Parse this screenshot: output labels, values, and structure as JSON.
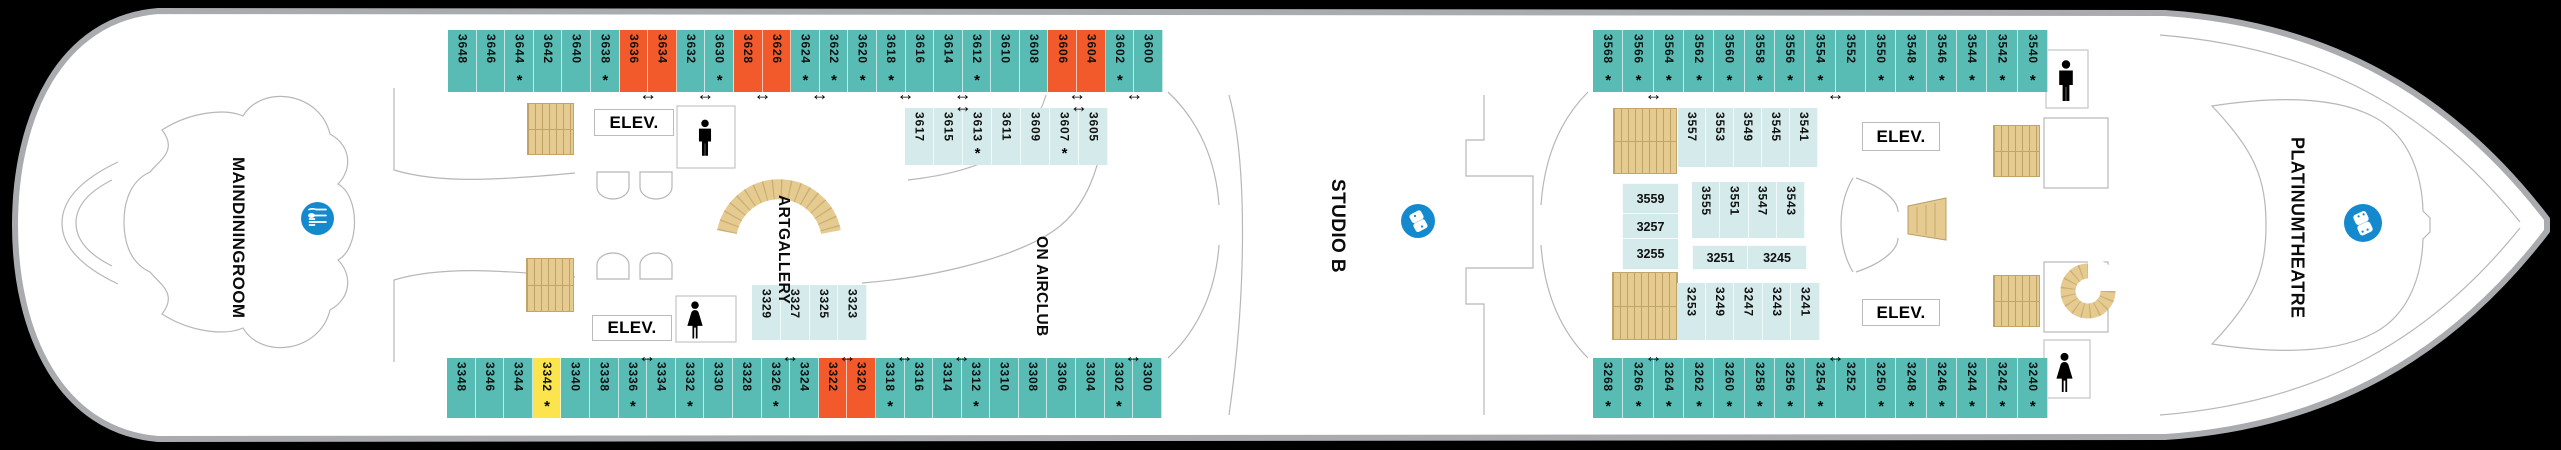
{
  "colors": {
    "teal": "#59BCB4",
    "orange": "#F2592B",
    "yellow": "#FBE44D",
    "inner": "#D4EAEB",
    "stairs": "#E6CB90",
    "blue": "#1489CE"
  },
  "glyphs": {
    "asterisk": "*",
    "door_arrow": "↔"
  },
  "labels": {
    "elevator": "ELEV."
  },
  "venues": {
    "main_dining_room": {
      "lines": [
        "MAIN",
        "DINING",
        "ROOM"
      ]
    },
    "art_gallery": {
      "lines": [
        "ART",
        "GALLERY"
      ]
    },
    "on_air_club": {
      "lines": [
        "ON AIR",
        "CLUB"
      ]
    },
    "studio_b": {
      "lines": [
        "STUDIO B"
      ]
    },
    "platinum_theatre": {
      "lines": [
        "PLATINUM",
        "THEATRE"
      ]
    }
  },
  "units": {
    "u3559": "3559",
    "u3257": "3257",
    "u3255": "3255",
    "u3251": "3251",
    "u3245": "3245"
  },
  "rows": {
    "tl_outer": {
      "edge": "bottom",
      "arrows": [
        6,
        8,
        10,
        12,
        15,
        17,
        21,
        23
      ],
      "cells": [
        [
          "3648",
          "s",
          0
        ],
        [
          "3646",
          "s",
          0
        ],
        [
          "3644",
          "s",
          1
        ],
        [
          "3642",
          "s",
          0
        ],
        [
          "3640",
          "s",
          0
        ],
        [
          "3638",
          "s",
          1
        ],
        [
          "3636",
          "o",
          0
        ],
        [
          "3634",
          "o",
          0
        ],
        [
          "3632",
          "s",
          0
        ],
        [
          "3630",
          "s",
          1
        ],
        [
          "3628",
          "o",
          0
        ],
        [
          "3626",
          "o",
          0
        ],
        [
          "3624",
          "s",
          1
        ],
        [
          "3622",
          "s",
          1
        ],
        [
          "3620",
          "s",
          1
        ],
        [
          "3618",
          "s",
          1
        ],
        [
          "3616",
          "s",
          0
        ],
        [
          "3614",
          "s",
          0
        ],
        [
          "3612",
          "s",
          1
        ],
        [
          "3610",
          "s",
          0
        ],
        [
          "3608",
          "s",
          0
        ],
        [
          "3606",
          "o",
          0
        ],
        [
          "3604",
          "o",
          0
        ],
        [
          "3602",
          "s",
          1
        ],
        [
          "3600",
          "s",
          0
        ]
      ]
    },
    "tl_inner": {
      "edge": "top",
      "arrows": [
        1,
        5
      ],
      "cells": [
        [
          "3617",
          "i",
          0
        ],
        [
          "3615",
          "i",
          0
        ],
        [
          "3613",
          "i",
          1
        ],
        [
          "3611",
          "i",
          0
        ],
        [
          "3609",
          "i",
          0
        ],
        [
          "3607",
          "i",
          1
        ],
        [
          "3605",
          "i",
          0
        ]
      ]
    },
    "bl_outer": {
      "edge": "top",
      "arrows": [
        6,
        11,
        13,
        15,
        17,
        23
      ],
      "cells": [
        [
          "3348",
          "s",
          0
        ],
        [
          "3346",
          "s",
          0
        ],
        [
          "3344",
          "s",
          0
        ],
        [
          "3342",
          "y",
          1
        ],
        [
          "3340",
          "s",
          0
        ],
        [
          "3338",
          "s",
          0
        ],
        [
          "3336",
          "s",
          1
        ],
        [
          "3334",
          "s",
          0
        ],
        [
          "3332",
          "s",
          1
        ],
        [
          "3330",
          "s",
          0
        ],
        [
          "3328",
          "s",
          0
        ],
        [
          "3326",
          "s",
          1
        ],
        [
          "3324",
          "s",
          0
        ],
        [
          "3322",
          "o",
          0
        ],
        [
          "3320",
          "o",
          0
        ],
        [
          "3318",
          "s",
          1
        ],
        [
          "3316",
          "s",
          0
        ],
        [
          "3314",
          "s",
          0
        ],
        [
          "3312",
          "s",
          1
        ],
        [
          "3310",
          "s",
          0
        ],
        [
          "3308",
          "s",
          0
        ],
        [
          "3306",
          "s",
          0
        ],
        [
          "3304",
          "s",
          0
        ],
        [
          "3302",
          "s",
          1
        ],
        [
          "3300",
          "s",
          0
        ]
      ]
    },
    "bl_inner": {
      "edge": "top",
      "arrows": [],
      "cells": [
        [
          "3329",
          "i",
          0
        ],
        [
          "3327",
          "i",
          0
        ],
        [
          "3325",
          "i",
          0
        ],
        [
          "3323",
          "i",
          0
        ]
      ]
    },
    "tr_outer": {
      "edge": "bottom",
      "arrows": [
        1,
        7
      ],
      "cells": [
        [
          "3568",
          "s",
          1
        ],
        [
          "3566",
          "s",
          1
        ],
        [
          "3564",
          "s",
          1
        ],
        [
          "3562",
          "s",
          1
        ],
        [
          "3560",
          "s",
          1
        ],
        [
          "3558",
          "s",
          1
        ],
        [
          "3556",
          "s",
          1
        ],
        [
          "3554",
          "s",
          1
        ],
        [
          "3552",
          "s",
          0
        ],
        [
          "3550",
          "s",
          1
        ],
        [
          "3548",
          "s",
          1
        ],
        [
          "3546",
          "s",
          1
        ],
        [
          "3544",
          "s",
          1
        ],
        [
          "3542",
          "s",
          1
        ],
        [
          "3540",
          "s",
          1
        ]
      ]
    },
    "br_outer": {
      "edge": "top",
      "arrows": [
        1,
        7
      ],
      "cells": [
        [
          "3268",
          "s",
          1
        ],
        [
          "3266",
          "s",
          1
        ],
        [
          "3264",
          "s",
          1
        ],
        [
          "3262",
          "s",
          1
        ],
        [
          "3260",
          "s",
          1
        ],
        [
          "3258",
          "s",
          1
        ],
        [
          "3256",
          "s",
          1
        ],
        [
          "3254",
          "s",
          1
        ],
        [
          "3252",
          "s",
          0
        ],
        [
          "3250",
          "s",
          1
        ],
        [
          "3248",
          "s",
          1
        ],
        [
          "3246",
          "s",
          1
        ],
        [
          "3244",
          "s",
          1
        ],
        [
          "3242",
          "s",
          1
        ],
        [
          "3240",
          "s",
          1
        ]
      ]
    },
    "r_inner_a": {
      "edge": "top",
      "arrows": [],
      "cells": [
        [
          "3557",
          "i",
          0
        ],
        [
          "3553",
          "i",
          0
        ],
        [
          "3549",
          "i",
          0
        ],
        [
          "3545",
          "i",
          0
        ],
        [
          "3541",
          "i",
          0
        ]
      ]
    },
    "r_inner_b": {
      "edge": "top",
      "arrows": [],
      "cells": [
        [
          "3555",
          "i",
          0
        ],
        [
          "3551",
          "i",
          0
        ],
        [
          "3547",
          "i",
          0
        ],
        [
          "3543",
          "i",
          0
        ]
      ]
    },
    "r_inner_c": {
      "edge": "top",
      "arrows": [],
      "cells": [
        [
          "3253",
          "i",
          0
        ],
        [
          "3249",
          "i",
          0
        ],
        [
          "3247",
          "i",
          0
        ],
        [
          "3243",
          "i",
          0
        ],
        [
          "3241",
          "i",
          0
        ]
      ]
    }
  }
}
